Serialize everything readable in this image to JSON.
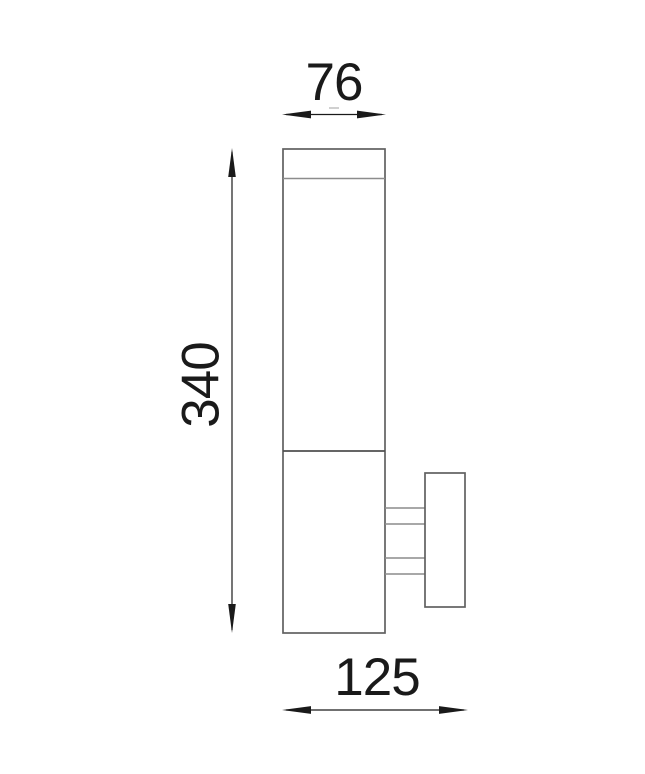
{
  "drawing": {
    "kind": "technical dimension drawing",
    "subject": "cylindrical wall-mounted light fixture with mounting bracket, side elevation",
    "labels": {
      "width": "76",
      "height": "340",
      "depth": "125"
    }
  },
  "colors": {
    "background": "#ffffff",
    "outline": "#606060",
    "inner_line": "#8c8c8c",
    "seam_line": "#4f4f4f",
    "dimension": "#1a1a1a",
    "center_tick": "#b0b0b0"
  }
}
